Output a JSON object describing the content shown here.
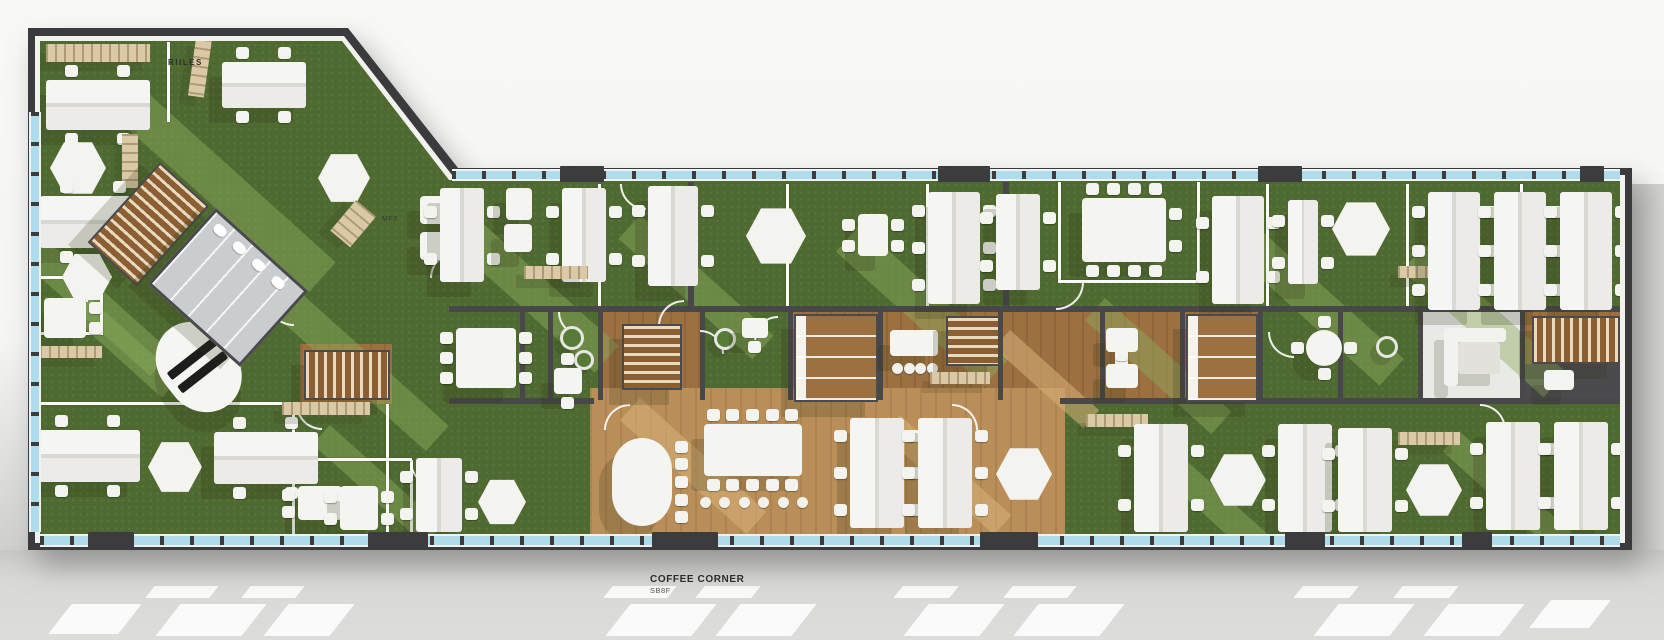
{
  "labels": {
    "room_a": "RIILES",
    "room_b": "MF3",
    "coffee": {
      "title": "COFFEE CORNER",
      "subtitle": "SB8F"
    }
  },
  "colors": {
    "wall": "#3b3b3d",
    "floor_green": "#4e6a31",
    "floor_green_light": "#90ad5f",
    "wood": "#9c7040",
    "wood_light": "#b98e58",
    "window_blue": "#aedcea",
    "furniture_white": "#f2f2ef",
    "shelf_beige": "#d9c9a6",
    "gray_room": "#c9cdd0",
    "dark_room": "#4b4b4d",
    "bg_top": "#f7f7f5",
    "bg_ground": "#d9d9d7"
  },
  "floorplan": {
    "zones": [
      {
        "x": 600,
        "y": 310,
        "w": 100,
        "h": 92,
        "f": "wood"
      },
      {
        "x": 788,
        "y": 310,
        "w": 472,
        "h": 92,
        "f": "wood"
      },
      {
        "x": 590,
        "y": 388,
        "w": 475,
        "h": 148,
        "f": "wood2"
      },
      {
        "x": 1525,
        "y": 310,
        "w": 97,
        "h": 56,
        "f": "wood"
      },
      {
        "x": 1420,
        "y": 312,
        "w": 100,
        "h": 88,
        "f": "white"
      },
      {
        "x": 1525,
        "y": 364,
        "w": 97,
        "h": 36,
        "f": "dark"
      },
      {
        "x": 300,
        "y": 344,
        "w": 92,
        "h": 60,
        "f": "wood"
      }
    ],
    "streaks": [
      [
        150,
        95,
        250,
        40,
        ""
      ],
      [
        30,
        225,
        190,
        32,
        ""
      ],
      [
        300,
        292,
        200,
        34,
        ""
      ],
      [
        470,
        212,
        200,
        36,
        ""
      ],
      [
        640,
        215,
        180,
        32,
        ""
      ],
      [
        860,
        225,
        200,
        36,
        ""
      ],
      [
        1105,
        298,
        170,
        30,
        ""
      ],
      [
        1255,
        225,
        200,
        36,
        ""
      ],
      [
        1425,
        245,
        190,
        34,
        ""
      ],
      [
        330,
        425,
        150,
        26,
        ""
      ],
      [
        1150,
        428,
        160,
        28,
        ""
      ],
      [
        1460,
        432,
        150,
        26,
        ""
      ],
      [
        90,
        298,
        120,
        26,
        ""
      ],
      [
        640,
        398,
        170,
        30,
        "wood"
      ],
      [
        900,
        415,
        150,
        26,
        "wood"
      ],
      [
        1010,
        330,
        120,
        24,
        "wood"
      ]
    ],
    "walls": [
      [
        "w",
        167,
        42,
        3,
        80
      ],
      [
        "w",
        30,
        276,
        72,
        3
      ],
      [
        "w",
        30,
        332,
        72,
        3
      ],
      [
        "w",
        100,
        276,
        3,
        59
      ],
      [
        "w",
        40,
        402,
        252,
        3
      ],
      [
        "w",
        292,
        404,
        3,
        131
      ],
      [
        "w",
        386,
        404,
        3,
        131
      ],
      [
        "w",
        410,
        460,
        3,
        75
      ],
      [
        "w",
        292,
        458,
        120,
        3
      ],
      [
        "w",
        598,
        184,
        3,
        124
      ],
      [
        "w",
        786,
        184,
        3,
        124
      ],
      [
        "w",
        926,
        184,
        3,
        124
      ],
      [
        "d",
        688,
        182,
        6,
        126
      ],
      [
        "d",
        1003,
        182,
        6,
        126
      ],
      [
        "w",
        1058,
        182,
        3,
        100
      ],
      [
        "w",
        1197,
        182,
        3,
        100
      ],
      [
        "w",
        1058,
        280,
        142,
        3
      ],
      [
        "w",
        1266,
        184,
        3,
        124
      ],
      [
        "w",
        1406,
        184,
        3,
        124
      ],
      [
        "w",
        1520,
        184,
        3,
        124
      ],
      [
        "d",
        449,
        306,
        1173,
        6
      ],
      [
        "d",
        449,
        398,
        145,
        6
      ],
      [
        "d",
        1060,
        398,
        562,
        6
      ],
      [
        "d",
        520,
        310,
        5,
        90
      ],
      [
        "d",
        548,
        310,
        5,
        90
      ],
      [
        "d",
        598,
        310,
        5,
        90
      ],
      [
        "d",
        700,
        310,
        5,
        90
      ],
      [
        "d",
        788,
        310,
        5,
        90
      ],
      [
        "d",
        878,
        310,
        5,
        90
      ],
      [
        "d",
        998,
        310,
        5,
        90
      ],
      [
        "d",
        1100,
        310,
        5,
        90
      ],
      [
        "d",
        1180,
        310,
        5,
        90
      ],
      [
        "d",
        1258,
        310,
        5,
        90
      ],
      [
        "d",
        1338,
        310,
        5,
        90
      ],
      [
        "d",
        1418,
        310,
        5,
        90
      ],
      [
        "d",
        1520,
        310,
        5,
        90
      ]
    ],
    "doors": [
      [
        266,
        298,
        26,
        0
      ],
      [
        430,
        252,
        24,
        90
      ],
      [
        620,
        184,
        24,
        0
      ],
      [
        700,
        330,
        22,
        180
      ],
      [
        754,
        316,
        22,
        90
      ],
      [
        1056,
        282,
        26,
        270
      ],
      [
        558,
        312,
        22,
        0
      ],
      [
        1268,
        332,
        24,
        0
      ],
      [
        86,
        276,
        24,
        90
      ],
      [
        296,
        404,
        24,
        0
      ],
      [
        1480,
        404,
        24,
        180
      ],
      [
        658,
        300,
        24,
        90
      ],
      [
        410,
        462,
        22,
        0
      ],
      [
        952,
        404,
        24,
        180
      ],
      [
        604,
        404,
        24,
        90
      ]
    ],
    "windows": [
      {
        "x": 40,
        "y": 534,
        "w": 1580,
        "h": 13
      },
      {
        "x": 452,
        "y": 169,
        "w": 1168,
        "h": 12
      },
      {
        "x": 29,
        "y": 112,
        "w": 12,
        "h": 420
      }
    ],
    "window_doors": [
      [
        88,
        532,
        46,
        16
      ],
      [
        368,
        532,
        60,
        16
      ],
      [
        652,
        532,
        66,
        16
      ],
      [
        980,
        532,
        58,
        16
      ],
      [
        1285,
        532,
        40,
        16
      ],
      [
        1462,
        532,
        30,
        16
      ],
      [
        560,
        166,
        44,
        16
      ],
      [
        938,
        166,
        52,
        16
      ],
      [
        1258,
        166,
        44,
        16
      ],
      [
        1580,
        166,
        24,
        16
      ]
    ],
    "furniture": [
      {
        "t": "shelf",
        "x": 46,
        "y": 44,
        "w": 104,
        "h": 18
      },
      {
        "t": "shelf",
        "x": 196,
        "y": 38,
        "w": 16,
        "h": 58,
        "r": 8
      },
      {
        "t": "deskH",
        "x": 46,
        "y": 80,
        "w": 104,
        "h": 50
      },
      {
        "t": "deskH",
        "x": 222,
        "y": 62,
        "w": 84,
        "h": 46
      },
      {
        "t": "cluster",
        "x": 50,
        "y": 140,
        "w": 56,
        "h": 56
      },
      {
        "t": "shelf",
        "x": 122,
        "y": 134,
        "w": 16,
        "h": 54
      },
      {
        "t": "deskH",
        "x": 40,
        "y": 196,
        "w": 106,
        "h": 52
      },
      {
        "t": "cluster",
        "x": 62,
        "y": 252,
        "w": 50,
        "h": 50
      },
      {
        "t": "table2",
        "x": 44,
        "y": 298,
        "w": 42,
        "h": 40,
        "c": {
          "l": 2,
          "r": 2
        }
      },
      {
        "t": "shelf",
        "x": 40,
        "y": 346,
        "w": 62,
        "h": 12
      },
      {
        "t": "recep",
        "x": 140,
        "y": 352,
        "w": 74,
        "h": 96,
        "r": -38
      },
      {
        "t": "deskH",
        "x": 36,
        "y": 430,
        "w": 104,
        "h": 52
      },
      {
        "t": "cluster",
        "x": 148,
        "y": 440,
        "w": 54,
        "h": 54
      },
      {
        "t": "deskH",
        "x": 214,
        "y": 432,
        "w": 104,
        "h": 52
      },
      {
        "t": "cluster",
        "x": 318,
        "y": 152,
        "w": 52,
        "h": 52
      },
      {
        "t": "shelf",
        "x": 356,
        "y": 200,
        "w": 26,
        "h": 40,
        "r": 40
      },
      {
        "t": "table2",
        "x": 420,
        "y": 196,
        "w": 34,
        "h": 28
      },
      {
        "t": "table2",
        "x": 420,
        "y": 232,
        "w": 34,
        "h": 28
      },
      {
        "t": "stairs",
        "x": 160,
        "y": 162,
        "w": 62,
        "h": 104,
        "r": 42,
        "d": "v"
      },
      {
        "t": "grayroom",
        "x": 216,
        "y": 208,
        "w": 118,
        "h": 96,
        "r": 42
      },
      {
        "t": "stairs",
        "x": 304,
        "y": 350,
        "w": 82,
        "h": 46,
        "d": "h"
      },
      {
        "t": "shelf",
        "x": 282,
        "y": 402,
        "w": 88,
        "h": 13
      },
      {
        "t": "deskV",
        "x": 440,
        "y": 188,
        "w": 44,
        "h": 94
      },
      {
        "t": "table2",
        "x": 506,
        "y": 188,
        "w": 26,
        "h": 32
      },
      {
        "t": "table2",
        "x": 504,
        "y": 224,
        "w": 28,
        "h": 28
      },
      {
        "t": "deskV",
        "x": 562,
        "y": 188,
        "w": 44,
        "h": 94
      },
      {
        "t": "shelf",
        "x": 524,
        "y": 266,
        "w": 64,
        "h": 13
      },
      {
        "t": "deskV",
        "x": 648,
        "y": 186,
        "w": 50,
        "h": 100
      },
      {
        "t": "cluster",
        "x": 746,
        "y": 206,
        "w": 60,
        "h": 60
      },
      {
        "t": "table2",
        "x": 858,
        "y": 214,
        "w": 30,
        "h": 42,
        "c": {
          "l": 2,
          "r": 2
        }
      },
      {
        "t": "deskV",
        "x": 928,
        "y": 192,
        "w": 52,
        "h": 112
      },
      {
        "t": "deskV",
        "x": 996,
        "y": 194,
        "w": 44,
        "h": 96
      },
      {
        "t": "conf",
        "x": 1082,
        "y": 198,
        "w": 84,
        "h": 64,
        "c": {
          "t": 4,
          "b": 4,
          "r": 2
        }
      },
      {
        "t": "deskV",
        "x": 1212,
        "y": 196,
        "w": 52,
        "h": 108
      },
      {
        "t": "deskV",
        "x": 1288,
        "y": 200,
        "w": 30,
        "h": 84
      },
      {
        "t": "cluster",
        "x": 1332,
        "y": 200,
        "w": 58,
        "h": 58
      },
      {
        "t": "shelf",
        "x": 1398,
        "y": 266,
        "w": 62,
        "h": 12
      },
      {
        "t": "deskV",
        "x": 1428,
        "y": 192,
        "w": 52,
        "h": 118
      },
      {
        "t": "deskV",
        "x": 1494,
        "y": 192,
        "w": 52,
        "h": 118
      },
      {
        "t": "deskV",
        "x": 1560,
        "y": 192,
        "w": 52,
        "h": 118
      },
      {
        "t": "conf",
        "x": 456,
        "y": 328,
        "w": 60,
        "h": 60,
        "c": {
          "l": 3,
          "r": 3
        }
      },
      {
        "t": "plant",
        "x": 560,
        "y": 326,
        "w": 18,
        "h": 18
      },
      {
        "t": "plant",
        "x": 574,
        "y": 350,
        "w": 14,
        "h": 14
      },
      {
        "t": "table2",
        "x": 554,
        "y": 368,
        "w": 28,
        "h": 26,
        "c": {
          "t": 1,
          "b": 1
        }
      },
      {
        "t": "stairs",
        "x": 622,
        "y": 324,
        "w": 56,
        "h": 62,
        "d": "v"
      },
      {
        "t": "plant",
        "x": 714,
        "y": 328,
        "w": 16,
        "h": 16
      },
      {
        "t": "table2",
        "x": 742,
        "y": 318,
        "w": 26,
        "h": 20,
        "c": {
          "b": 1
        }
      },
      {
        "t": "booths",
        "x": 794,
        "y": 314,
        "w": 80,
        "h": 84
      },
      {
        "t": "conf",
        "x": 890,
        "y": 330,
        "w": 48,
        "h": 26
      },
      {
        "t": "stools",
        "x": 892,
        "y": 362,
        "w": 46,
        "h": 12,
        "n": 4
      },
      {
        "t": "stairs",
        "x": 946,
        "y": 316,
        "w": 50,
        "h": 46,
        "d": "v"
      },
      {
        "t": "shelf",
        "x": 930,
        "y": 372,
        "w": 60,
        "h": 12
      },
      {
        "t": "table2",
        "x": 1106,
        "y": 328,
        "w": 32,
        "h": 24,
        "c": {
          "b": 1
        }
      },
      {
        "t": "table2",
        "x": 1106,
        "y": 364,
        "w": 32,
        "h": 24,
        "c": {
          "t": 1
        }
      },
      {
        "t": "booths",
        "x": 1186,
        "y": 314,
        "w": 68,
        "h": 84
      },
      {
        "t": "round",
        "x": 1306,
        "y": 330,
        "w": 36,
        "h": 36
      },
      {
        "t": "plant",
        "x": 1376,
        "y": 336,
        "w": 16,
        "h": 16
      },
      {
        "t": "sofa",
        "x": 1444,
        "y": 328,
        "w": 62,
        "h": 58
      },
      {
        "t": "stairs",
        "x": 1532,
        "y": 316,
        "w": 84,
        "h": 44,
        "d": "h"
      },
      {
        "t": "conf",
        "x": 1544,
        "y": 370,
        "w": 30,
        "h": 20
      },
      {
        "t": "table2",
        "x": 298,
        "y": 486,
        "w": 44,
        "h": 34,
        "c": {
          "l": 2,
          "r": 2
        }
      },
      {
        "t": "conf",
        "x": 340,
        "y": 486,
        "w": 38,
        "h": 44,
        "c": {
          "l": 2,
          "r": 2
        }
      },
      {
        "t": "deskV",
        "x": 416,
        "y": 458,
        "w": 46,
        "h": 74
      },
      {
        "t": "cluster",
        "x": 478,
        "y": 478,
        "w": 48,
        "h": 48
      },
      {
        "t": "oval",
        "x": 612,
        "y": 438,
        "w": 60,
        "h": 88,
        "c": {
          "r": 5
        }
      },
      {
        "t": "conf",
        "x": 704,
        "y": 424,
        "w": 98,
        "h": 52,
        "c": {
          "t": 5,
          "b": 5
        }
      },
      {
        "t": "stools",
        "x": 700,
        "y": 496,
        "w": 108,
        "h": 14,
        "n": 6
      },
      {
        "t": "deskV",
        "x": 850,
        "y": 418,
        "w": 54,
        "h": 110
      },
      {
        "t": "deskV",
        "x": 918,
        "y": 418,
        "w": 54,
        "h": 110
      },
      {
        "t": "cluster",
        "x": 996,
        "y": 446,
        "w": 56,
        "h": 56
      },
      {
        "t": "shelf",
        "x": 1086,
        "y": 414,
        "w": 62,
        "h": 13
      },
      {
        "t": "deskV",
        "x": 1134,
        "y": 424,
        "w": 54,
        "h": 108
      },
      {
        "t": "cluster",
        "x": 1210,
        "y": 452,
        "w": 56,
        "h": 56
      },
      {
        "t": "deskV",
        "x": 1278,
        "y": 424,
        "w": 54,
        "h": 108
      },
      {
        "t": "shelf",
        "x": 1398,
        "y": 432,
        "w": 62,
        "h": 13
      },
      {
        "t": "deskV",
        "x": 1338,
        "y": 428,
        "w": 54,
        "h": 104
      },
      {
        "t": "cluster",
        "x": 1406,
        "y": 462,
        "w": 56,
        "h": 56
      },
      {
        "t": "deskV",
        "x": 1486,
        "y": 422,
        "w": 54,
        "h": 108
      },
      {
        "t": "deskV",
        "x": 1554,
        "y": 422,
        "w": 54,
        "h": 108
      }
    ],
    "ground_patches": [
      [
        150,
        586,
        64,
        12
      ],
      [
        246,
        586,
        54,
        12
      ],
      [
        608,
        586,
        64,
        12
      ],
      [
        700,
        586,
        56,
        12
      ],
      [
        898,
        586,
        56,
        12
      ],
      [
        1008,
        586,
        64,
        12
      ],
      [
        1298,
        586,
        56,
        12
      ],
      [
        1398,
        586,
        56,
        12
      ],
      [
        168,
        604,
        86,
        32
      ],
      [
        276,
        604,
        66,
        32
      ],
      [
        618,
        604,
        86,
        32
      ],
      [
        728,
        604,
        76,
        32
      ],
      [
        916,
        604,
        76,
        32
      ],
      [
        1026,
        604,
        86,
        32
      ],
      [
        1326,
        604,
        76,
        32
      ],
      [
        1436,
        604,
        76,
        32
      ],
      [
        60,
        604,
        70,
        30
      ],
      [
        1540,
        600,
        60,
        28
      ]
    ]
  }
}
